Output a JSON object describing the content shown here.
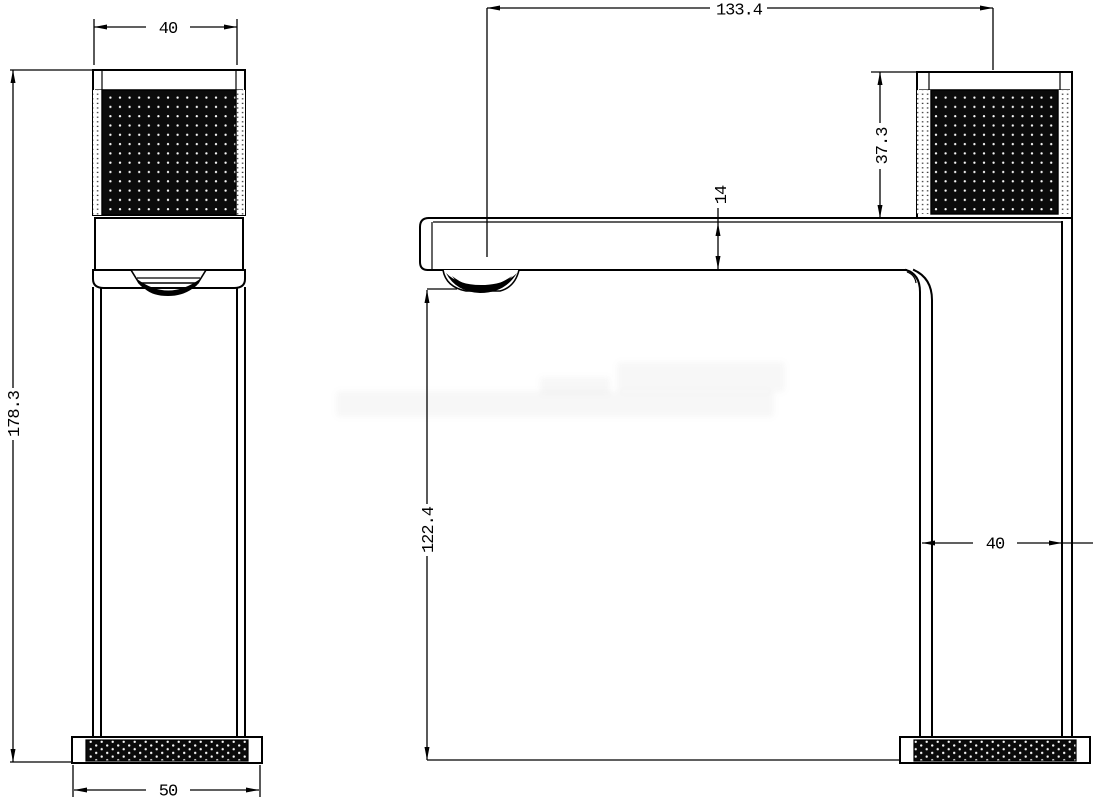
{
  "drawing": {
    "kind": "faucet technical dimension drawing, two orthographic views",
    "colors": {
      "background": "#ffffff",
      "line": "#000000",
      "knurl_fill": "#0b0b0b",
      "knurl_dot": "#fafafa"
    }
  },
  "dims": {
    "front_handle_width": "40",
    "spout_reach": "133.4",
    "overall_height": "178.3",
    "base_width": "50",
    "handle_height": "37.3",
    "spout_thickness": "14",
    "spout_height": "122.4",
    "body_depth": "40"
  }
}
